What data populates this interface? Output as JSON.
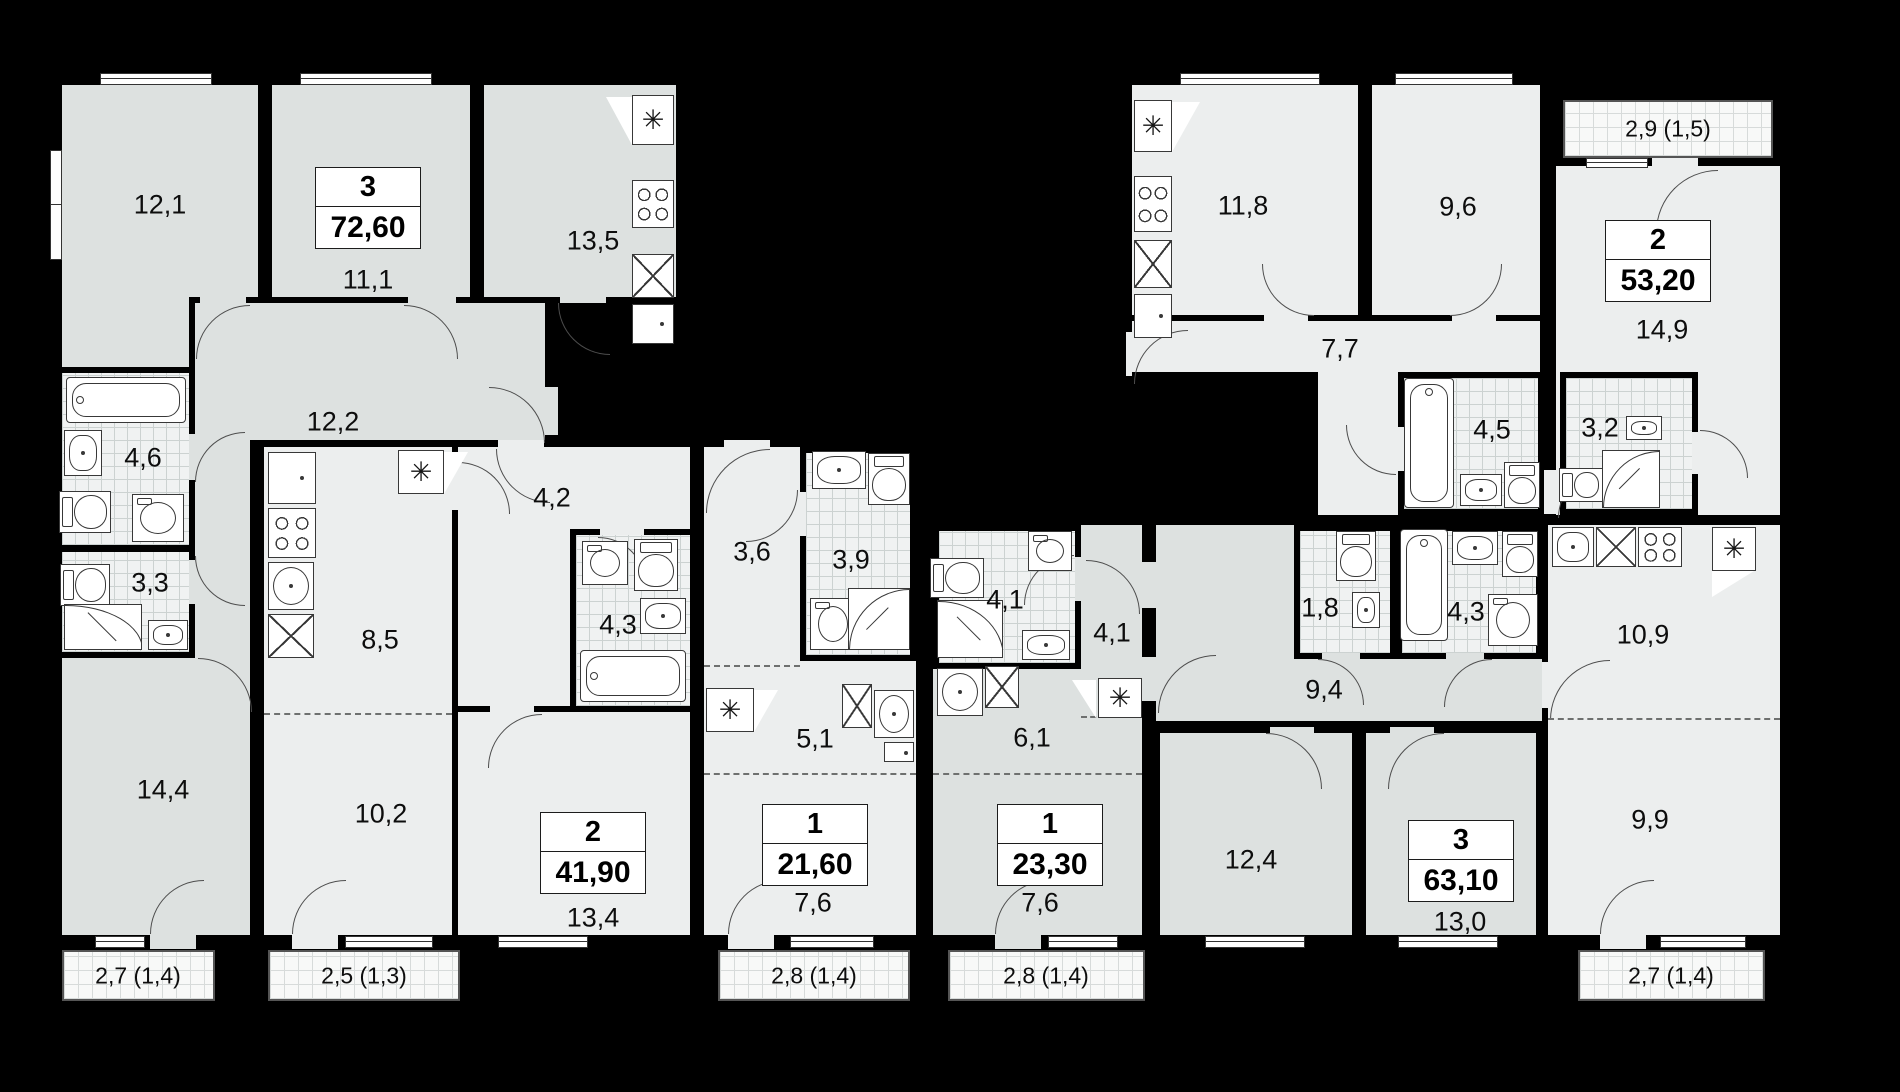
{
  "colors": {
    "background": "#000000",
    "wall": "#000000",
    "floor_light": "#eceeee",
    "floor_gray": "#dde1e0",
    "tile_floor": "#f0f2f2",
    "tile_line": "#ccd2d1",
    "label_text": "#0d0d0d"
  },
  "units": [
    {
      "id": "apt-a",
      "rooms": "3",
      "area": "72,60",
      "room_areas": [
        "12,1",
        "11,1",
        "13,5",
        "12,2",
        "4,6",
        "3,3",
        "14,4"
      ],
      "balcony": "2,7 (1,4)"
    },
    {
      "id": "apt-b",
      "rooms": "2",
      "area": "41,90",
      "room_areas": [
        "8,5",
        "10,2",
        "4,2",
        "4,3",
        "13,4"
      ],
      "balcony": "2,5 (1,3)"
    },
    {
      "id": "apt-c",
      "rooms": "1",
      "area": "21,60",
      "room_areas": [
        "3,6",
        "3,9",
        "5,1",
        "7,6"
      ],
      "balcony": "2,8 (1,4)"
    },
    {
      "id": "apt-d",
      "rooms": "1",
      "area": "23,30",
      "room_areas": [
        "4,1",
        "4,1",
        "6,1",
        "7,6"
      ],
      "balcony": "2,8 (1,4)"
    },
    {
      "id": "apt-e",
      "rooms": "2",
      "area": "53,20",
      "room_areas": [
        "11,8",
        "9,6",
        "7,7",
        "14,9",
        "4,5",
        "3,2"
      ],
      "balcony": "2,9 (1,5)"
    },
    {
      "id": "apt-f",
      "rooms": "3",
      "area": "63,10",
      "room_areas": [
        "9,4",
        "1,8",
        "4,3",
        "12,4",
        "13,0",
        "10,9",
        "9,9"
      ],
      "balcony": "2,7 (1,4)"
    }
  ]
}
